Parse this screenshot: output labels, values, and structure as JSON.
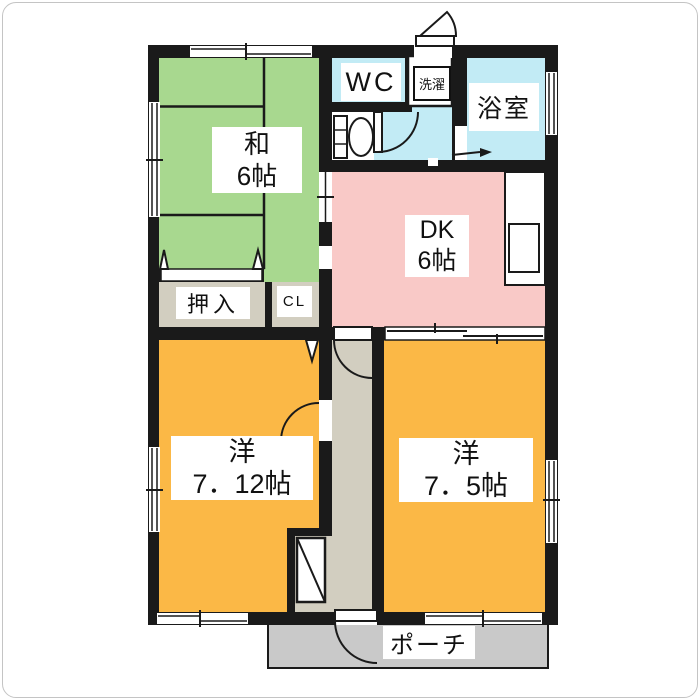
{
  "plan": {
    "type": "apartment-floorplan",
    "rooms": {
      "washitsu": {
        "name": "和",
        "size": "6帖"
      },
      "dk": {
        "name": "DK",
        "size": "6帖"
      },
      "western1": {
        "name": "洋",
        "size": "7．12帖"
      },
      "western2": {
        "name": "洋",
        "size": "7．5帖"
      },
      "wc": {
        "label": "WC"
      },
      "laundry": {
        "label": "洗濯"
      },
      "bath": {
        "label": "浴室"
      },
      "oshiire": {
        "label": "押入"
      },
      "closet": {
        "label": "CL"
      },
      "porch": {
        "label": "ポーチ"
      }
    },
    "colors": {
      "tatami_green": "#a8d88f",
      "room_orange": "#fbb846",
      "dk_pink": "#f9c9c7",
      "wet_blue": "#c2ebf5",
      "hall_beige": "#d2cec0",
      "porch_gray": "#c9c9c9",
      "wall_black": "#1a1a1a"
    }
  }
}
